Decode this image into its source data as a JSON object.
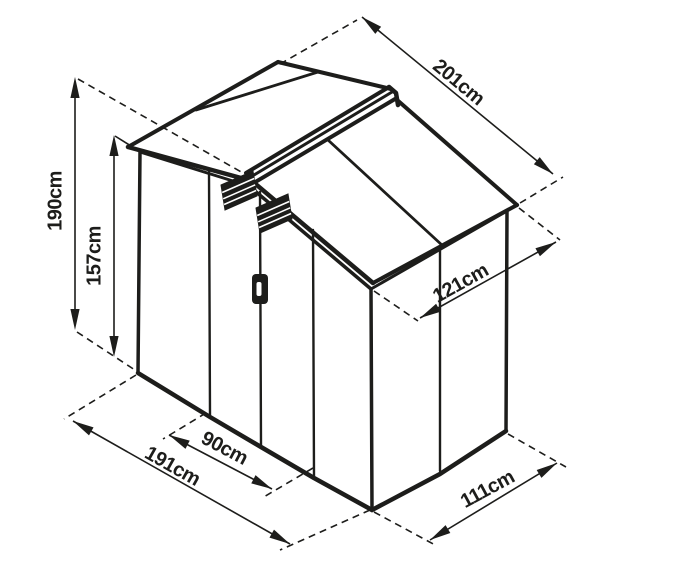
{
  "diagram": {
    "background_color": "#ffffff",
    "line_color": "#1d1d1b",
    "subject": "garden-shed-isometric-dimension-drawing",
    "dimensions": {
      "total_height": "190cm",
      "wall_height": "157cm",
      "roof_length": "201cm",
      "roof_depth": "121cm",
      "base_width": "191cm",
      "door_width": "90cm",
      "base_depth": "111cm"
    }
  }
}
